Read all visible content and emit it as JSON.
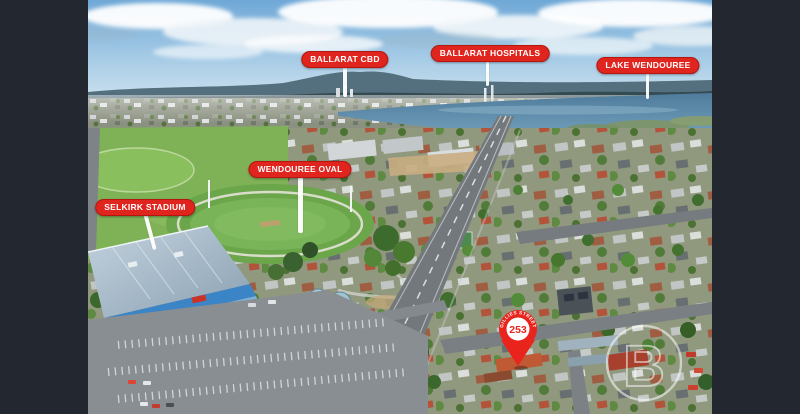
{
  "labels": {
    "ballarat_cbd": "BALLARAT CBD",
    "ballarat_hospitals": "BALLARAT HOSPITALS",
    "lake_wendouree": "LAKE WENDOUREE",
    "wendouree_oval": "WENDOUREE OVAL",
    "selkirk_stadium": "SELKIRK STADIUM"
  },
  "pin": {
    "number": "253",
    "street_arc": "GILLIES STREET"
  },
  "watermark": {
    "letter": "B"
  },
  "colors": {
    "frame_bg": "#232730",
    "label_bg": "#e0251f",
    "label_border": "#b5160f",
    "label_text": "#ffffff",
    "leader_line": "#ffffff",
    "pin_red": "#e8241d"
  }
}
